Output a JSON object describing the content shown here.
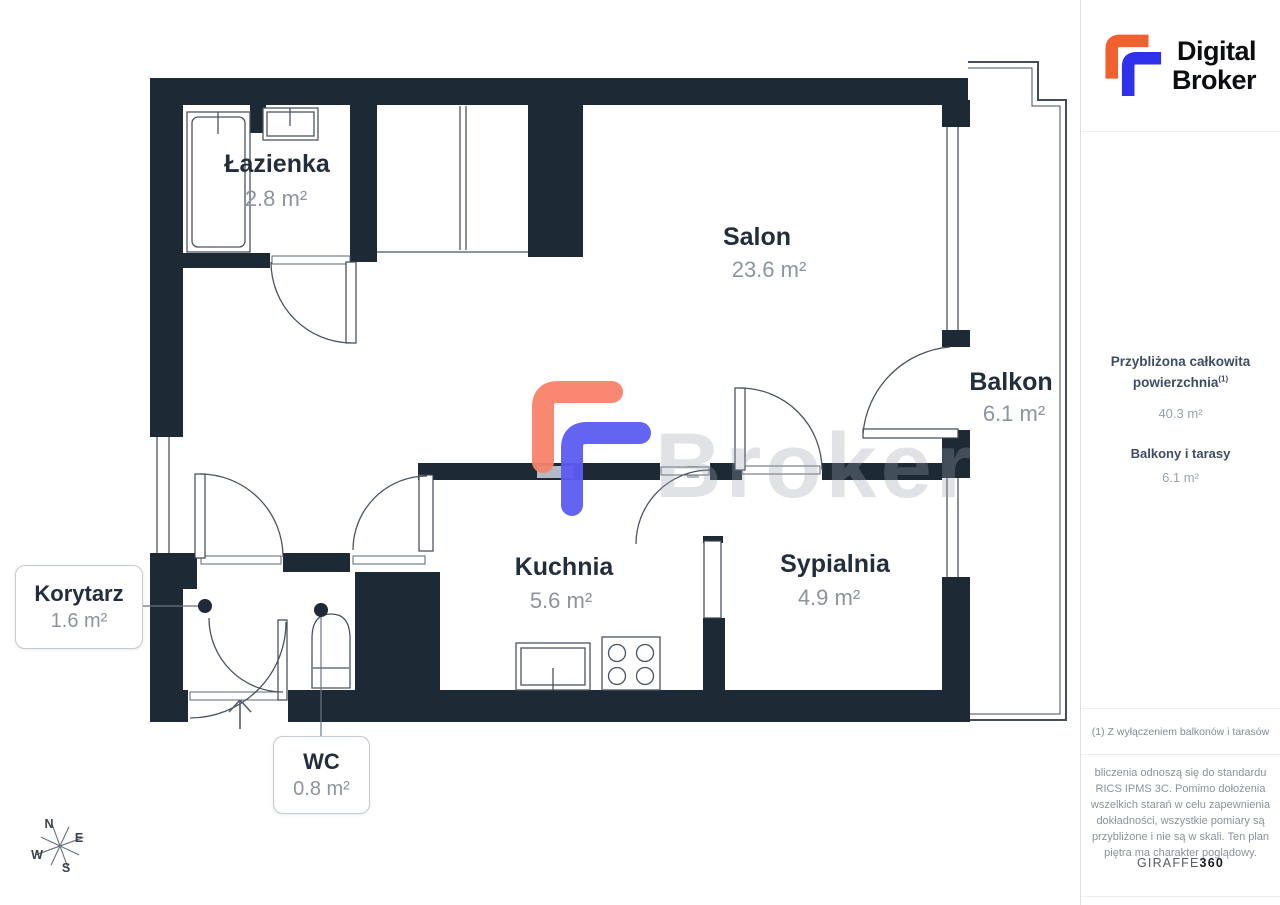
{
  "logo": {
    "line1": "Digital",
    "line2": "Broker"
  },
  "colors": {
    "wall": "#1e2936",
    "accent_orange": "#f1602f",
    "accent_blue": "#2f31ea",
    "watermark_orange": "#f8826a",
    "watermark_blue": "#5c5cf2",
    "label_dark": "#232e3d",
    "label_gray": "#8d949d"
  },
  "plan": {
    "rooms": [
      {
        "id": "lazienka",
        "name": "Łazienka",
        "area": "2.8 m²"
      },
      {
        "id": "salon",
        "name": "Salon",
        "area": "23.6 m²"
      },
      {
        "id": "balkon",
        "name": "Balkon",
        "area": "6.1 m²"
      },
      {
        "id": "kuchnia",
        "name": "Kuchnia",
        "area": "5.6 m²"
      },
      {
        "id": "sypialnia",
        "name": "Sypialnia",
        "area": "4.9 m²"
      }
    ],
    "callouts": [
      {
        "id": "korytarz",
        "name": "Korytarz",
        "area": "1.6 m²"
      },
      {
        "id": "wc",
        "name": "WC",
        "area": "0.8 m²"
      }
    ],
    "compass": {
      "n": "N",
      "e": "E",
      "s": "S",
      "w": "W"
    },
    "watermark_text": "Broker"
  },
  "sidebar": {
    "area_title_line1": "Przybliżona całkowita",
    "area_title_line2": "powierzchnia",
    "area_title_sup": "(1)",
    "area_value": "40.3 m²",
    "balcony_title": "Balkony i tarasy",
    "balcony_value": "6.1 m²",
    "footnote": "(1) Z wyłączeniem balkonów i tarasów",
    "disclaimer_lines": [
      "bliczenia odnoszą się do standardu",
      "RICS IPMS 3C. Pomimo dołożenia",
      "wszelkich starań w celu zapewnienia",
      "dokładności, wszystkie pomiary są",
      "przybliżone i nie są w skali. Ten plan",
      "piętra ma charakter poglądowy."
    ],
    "brand": "GIRAFFE",
    "brand_suffix": "360"
  }
}
